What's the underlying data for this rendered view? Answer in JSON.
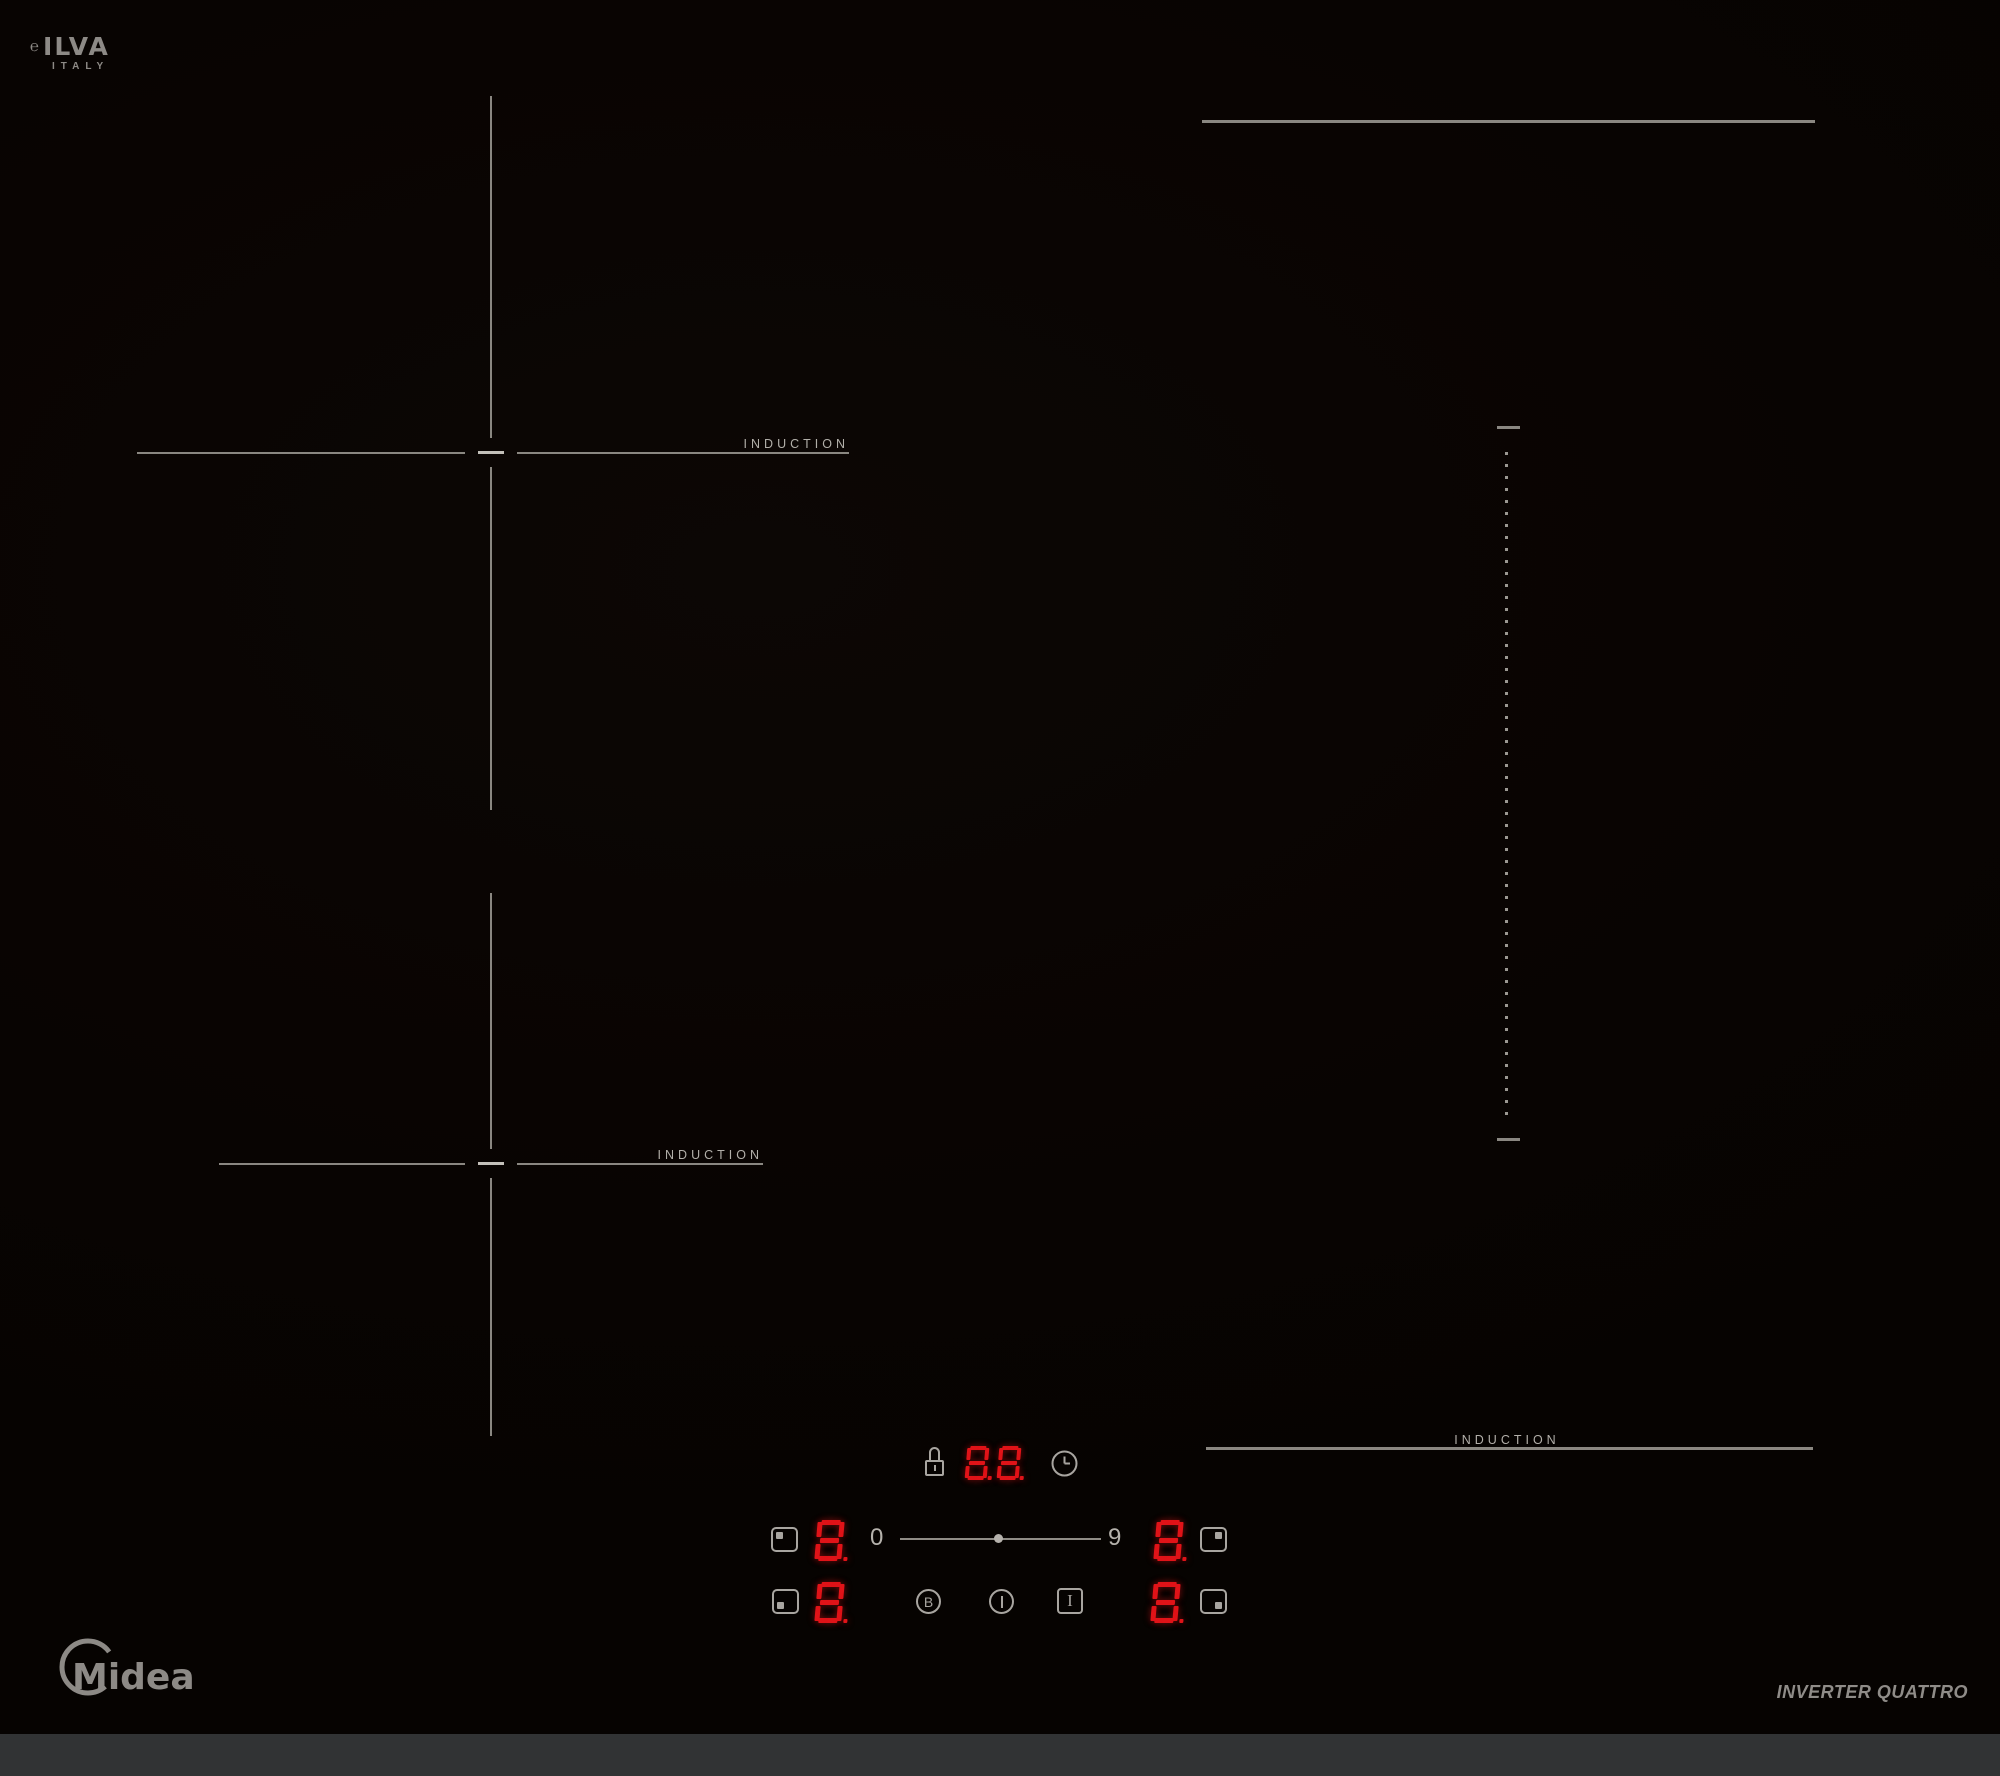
{
  "brand": {
    "ilva_mark": "℮",
    "ilva_name": "ILVA",
    "ilva_country": "ITALY",
    "midea_name": "Midea",
    "tagline": "INVERTER QUATTRO"
  },
  "surface": {
    "zone_rear_left_label": "INDUCTION",
    "zone_front_left_label": "INDUCTION",
    "zone_front_right_label": "INDUCTION"
  },
  "control_panel": {
    "timer": {
      "value": "8.8."
    },
    "power_scale": {
      "min": "0",
      "max": "9"
    },
    "displays": {
      "rear_left": "8.",
      "rear_right": "8.",
      "front_left": "8.",
      "front_right": "8."
    },
    "keys": {
      "booster_label": "B",
      "pause_label": "I"
    },
    "icons": {
      "lock": "padlock-outline",
      "timer": "clock-face",
      "power": "vertical-bar",
      "zone_rear_left": "square-dot-top-left",
      "zone_rear_right": "square-dot-top-right",
      "zone_front_left": "square-dot-bottom-left",
      "zone_front_right": "square-dot-bottom-right"
    }
  },
  "colors": {
    "led_red": "#e01318",
    "line_gray": "#8a8781",
    "key_gray": "#a8a5a0",
    "label_gray": "#b2afa9",
    "logo_gray": "#8d8a86",
    "bottom_strip": "#313334",
    "glass_black": "#090402"
  }
}
